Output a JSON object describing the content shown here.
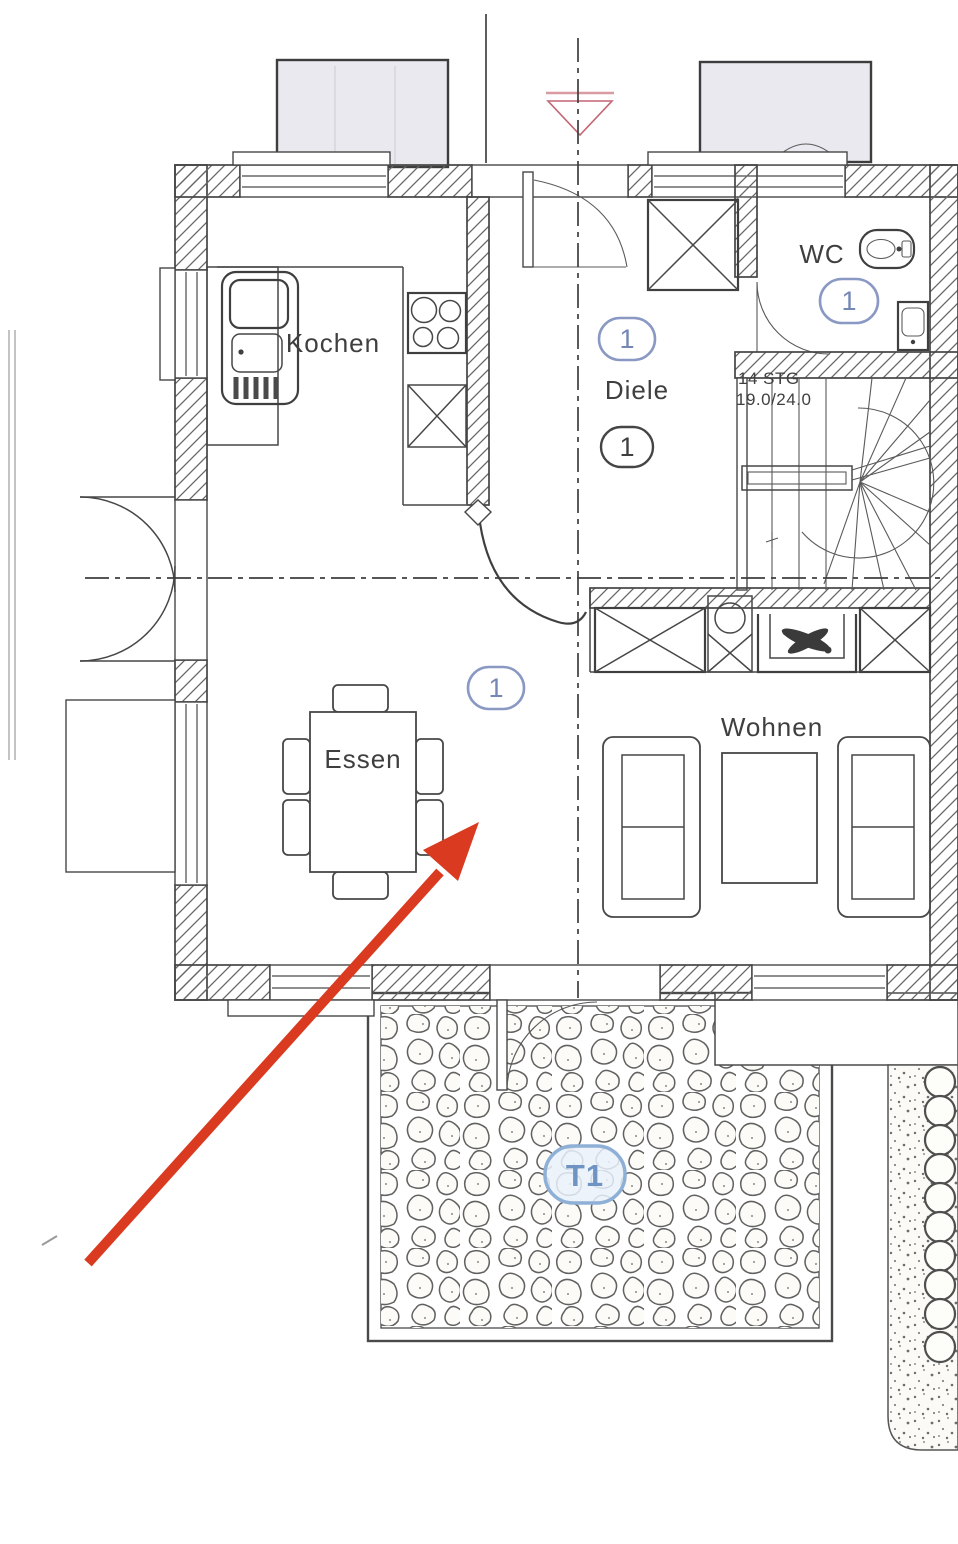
{
  "plan": {
    "rooms": {
      "kitchen": "Kochen",
      "hall": "Diele",
      "dining": "Essen",
      "living": "Wohnen",
      "wc": "WC"
    },
    "stairs": {
      "line1": "14 STG",
      "line2": "19.0/24.0"
    },
    "markers": {
      "hall_unit": "1",
      "hall_floor": "1",
      "wc_unit": "1",
      "dining_unit": "1",
      "terrace": "T1"
    },
    "colors": {
      "ink": "#3f3f3f",
      "marker_blue": "#8a98c4",
      "terrace_blue": "#6f94c4",
      "arrow_red": "#da3a20",
      "symbol_red": "#c46573",
      "dormer_fill": "#e9e9ef"
    }
  }
}
